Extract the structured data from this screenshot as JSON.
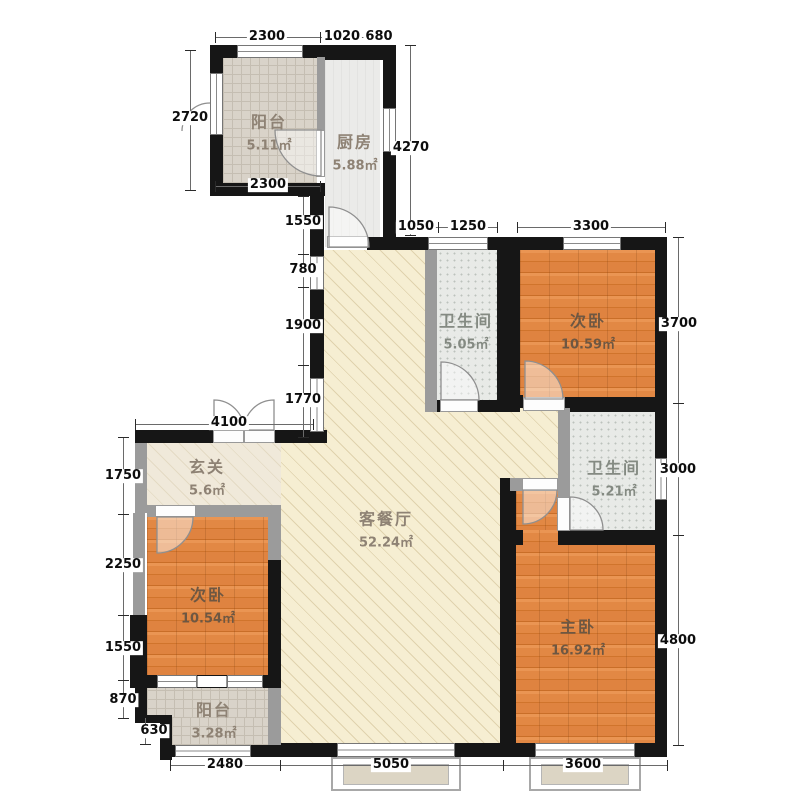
{
  "plan_title": "三室两厅两卫户型图",
  "rooms": [
    {
      "id": "balcony-north",
      "name": "阳台",
      "area": "5.11㎡"
    },
    {
      "id": "kitchen",
      "name": "厨房",
      "area": "5.88㎡"
    },
    {
      "id": "bath-north",
      "name": "卫生间",
      "area": "5.05㎡"
    },
    {
      "id": "bedroom-ne",
      "name": "次卧",
      "area": "10.59㎡"
    },
    {
      "id": "bath-east",
      "name": "卫生间",
      "area": "5.21㎡"
    },
    {
      "id": "foyer",
      "name": "玄关",
      "area": "5.6㎡"
    },
    {
      "id": "living-dining",
      "name": "客餐厅",
      "area": "52.24㎡"
    },
    {
      "id": "bedroom-west",
      "name": "次卧",
      "area": "10.54㎡"
    },
    {
      "id": "master-bedroom",
      "name": "主卧",
      "area": "16.92㎡"
    },
    {
      "id": "balcony-south",
      "name": "阳台",
      "area": "3.28㎡"
    }
  ],
  "dimensions": {
    "top_row": [
      "2300",
      "1020",
      "680"
    ],
    "second_row": [
      "1050",
      "1250",
      "3300"
    ],
    "left_outer": [
      "2720"
    ],
    "left_mid": [
      "1550",
      "780",
      "1900",
      "1770"
    ],
    "left_lower": [
      "1750",
      "2250",
      "1550",
      "870",
      "630"
    ],
    "right_col": [
      "4270",
      "3700",
      "3000",
      "4800"
    ],
    "middle": [
      "4100",
      "2300"
    ],
    "bottom_row": [
      "2480",
      "5050",
      "3600"
    ]
  },
  "colors": {
    "structural_wall": "#161616",
    "partition_wall": "#9b9b9b",
    "wood_floor": "#e0843c",
    "living_floor": "#f6eed2",
    "tile_floor": "#d9d3c9",
    "bath_floor": "#e8eae7"
  }
}
